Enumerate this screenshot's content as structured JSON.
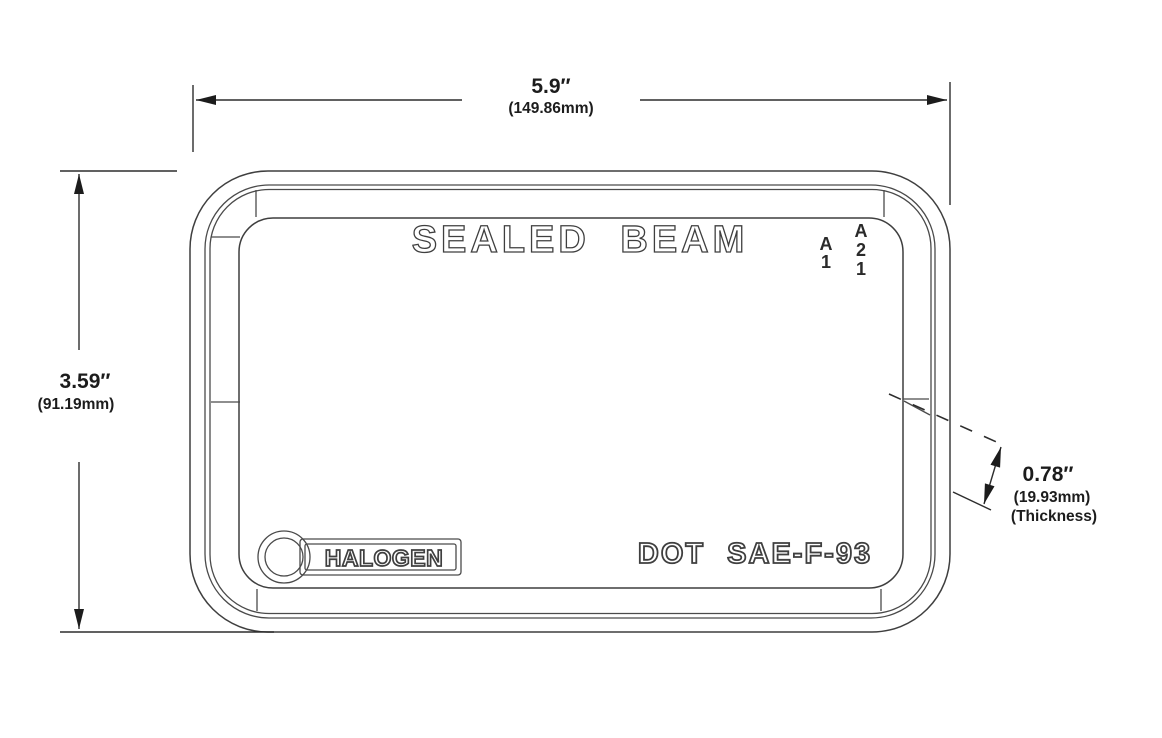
{
  "drawing": {
    "colors": {
      "line": "#3f3f3f",
      "text": "#1c1c1c",
      "background": "#ffffff"
    },
    "dimensions": {
      "width": {
        "inches": "5.9″",
        "metric": "(149.86mm)"
      },
      "height": {
        "inches": "3.59″",
        "metric": "(91.19mm)"
      },
      "thickness": {
        "inches": "0.78″",
        "metric": "(19.93mm)",
        "label": "(Thickness)"
      }
    },
    "markings": {
      "top": "SEALED BEAM",
      "code_left": [
        "A",
        "1"
      ],
      "code_right": [
        "A",
        "2",
        "1"
      ],
      "badge": "HALOGEN",
      "certification": "DOT SAE-F-93"
    }
  }
}
